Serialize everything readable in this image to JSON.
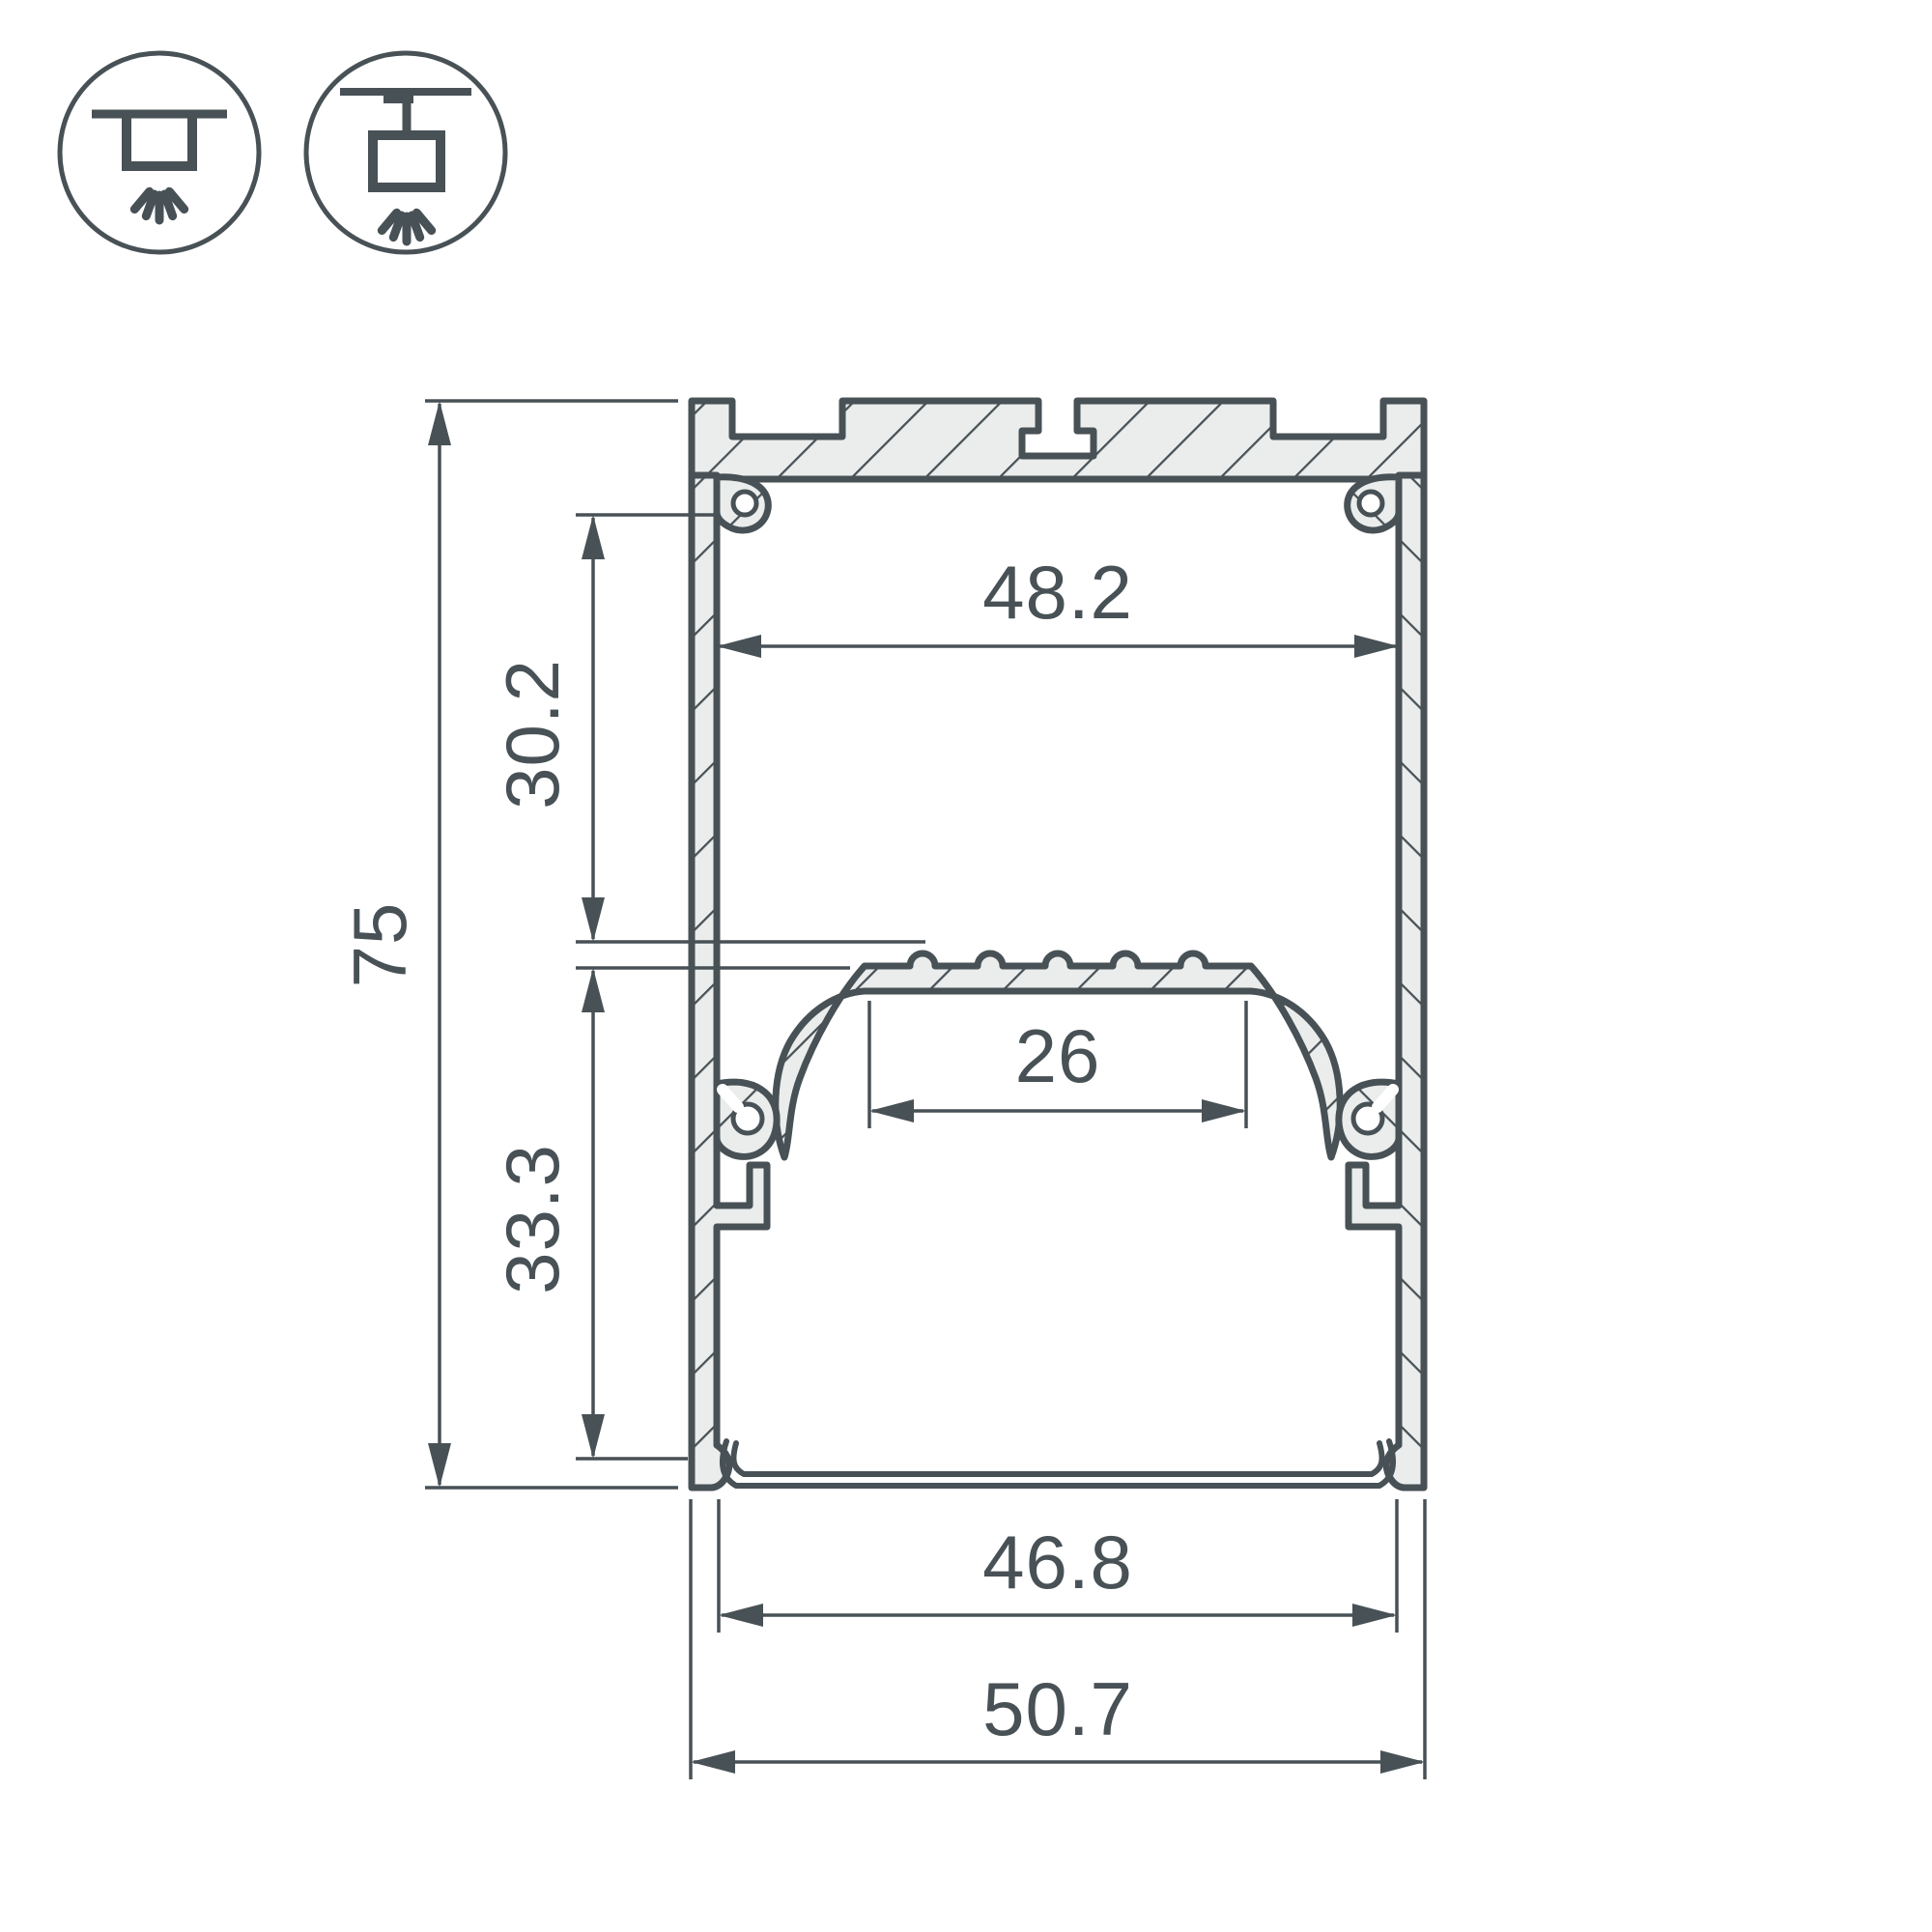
{
  "page": {
    "background": "#ffffff",
    "description": "Technical cross-section drawing of an aluminium LED strip profile with dimensions"
  },
  "drawing": {
    "line_color": "#485156",
    "material_fill": "#eaedec",
    "icons": [
      {
        "name": "ceiling-surface-mount-icon",
        "meaning": "surface ceiling mounting"
      },
      {
        "name": "pendant-suspension-mount-icon",
        "meaning": "suspended pendant mounting"
      }
    ],
    "dimensions": {
      "outer_height": "75",
      "upper_cavity_height": "30.2",
      "lower_cavity_height": "33.3",
      "upper_inner_width": "48.2",
      "led_platform_width": "26",
      "bottom_opening_width": "46.8",
      "outer_width": "50.7"
    }
  }
}
